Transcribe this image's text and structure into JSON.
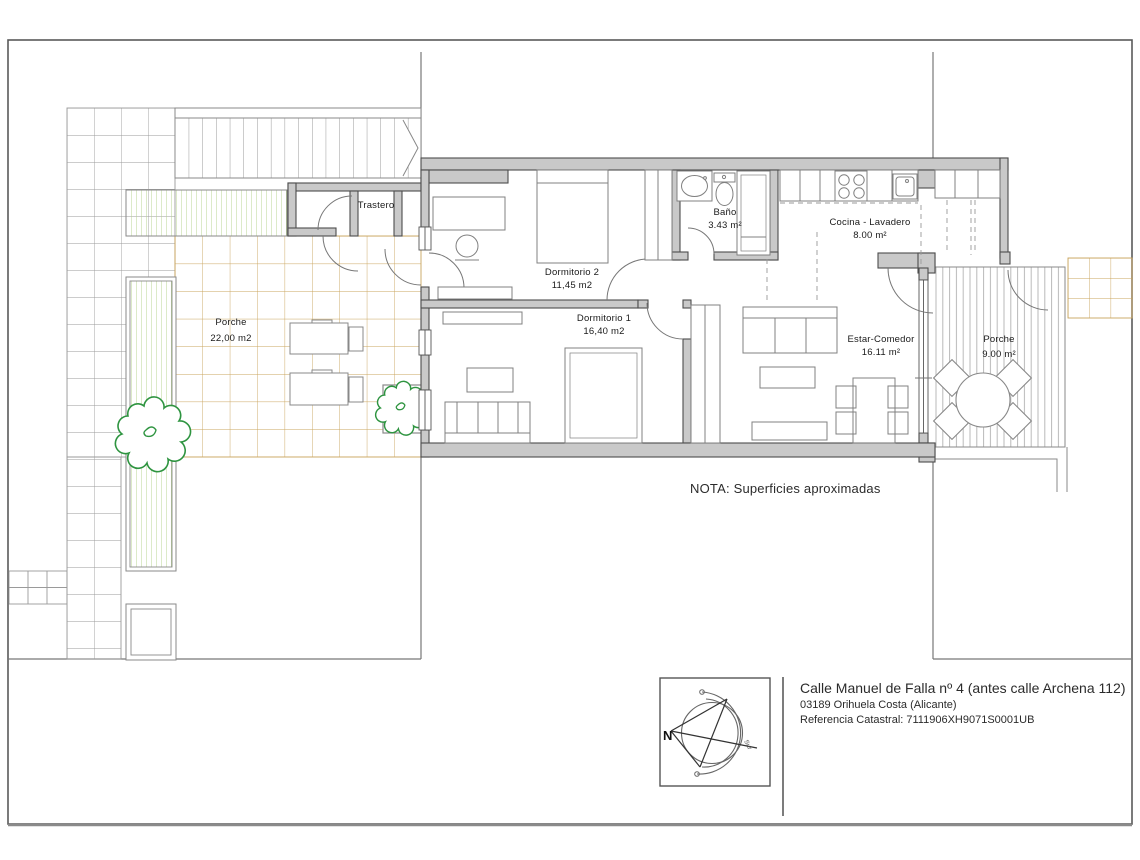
{
  "rooms": [
    {
      "id": "trastero",
      "name": "Trastero",
      "area": ""
    },
    {
      "id": "dormitorio-2",
      "name": "Dormitorio 2",
      "area": "11,45 m2"
    },
    {
      "id": "dormitorio-1",
      "name": "Dormitorio 1",
      "area": "16,40 m2"
    },
    {
      "id": "bano",
      "name": "Baño",
      "area": "3.43 m²"
    },
    {
      "id": "cocina",
      "name": "Cocina - Lavadero",
      "area": "8.00 m²"
    },
    {
      "id": "estar",
      "name": "Estar-Comedor",
      "area": "16.11 m²"
    },
    {
      "id": "porche-izq",
      "name": "Porche",
      "area": "22,00 m2"
    },
    {
      "id": "porche-der",
      "name": "Porche",
      "area": "9.00 m²"
    }
  ],
  "note": "NOTA: Superficies aproximadas",
  "compass": {
    "north": "N",
    "arc_label": "Sur"
  },
  "title_block": {
    "address": "Calle Manuel de Falla nº 4 (antes calle Archena 112)",
    "city": "03189 Orihuela Costa (Alicante)",
    "cadastral": "Referencia Catastral: 7111906XH9071S0001UB"
  },
  "colors": {
    "wall_fill": "#c9c9c9",
    "wall_stroke": "#4d4d4d",
    "tile_tan": "#c9a45c",
    "deck_green": "#b8d493",
    "tree_green": "#2e9440",
    "porch_hatch": "#b9b9b9",
    "line_gray": "#8a8a8a",
    "text": "#1a1a1a"
  }
}
